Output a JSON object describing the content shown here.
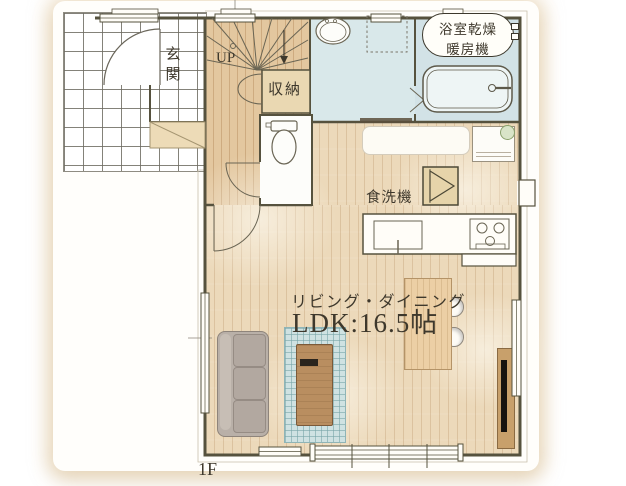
{
  "floorplan": {
    "floor_label": "1F",
    "rooms": {
      "entrance_label": "玄関",
      "stairs_label": "UP",
      "storage_label": "収納",
      "bath_heater_line1": "浴室乾燥",
      "bath_heater_line2": "暖房機",
      "dishwasher_label": "食洗機",
      "living_dining_label": "リビング・ダイニング",
      "ldk_size_label": "LDK:16.5帖"
    },
    "colors": {
      "wall": "#56523e",
      "wood_floor": "#ecd9ba",
      "hall_floor": "#e3c79f",
      "wet_area_floor": "#d9e8ea",
      "storage_fill": "#ead8b2",
      "rug": "#cfe2e2",
      "sofa": "#b9b0a8",
      "dining_table": "#eccfa5",
      "coffee_table": "#b98e60",
      "text": "#3e382c"
    },
    "icons": [
      "front-door-arc",
      "stairs-up-arrow",
      "storage-double-doors",
      "toilet",
      "washbasin",
      "washing-machine-pan",
      "bathtub",
      "folding-door",
      "sliding-window",
      "kitchen-sink",
      "gas-stove",
      "dishwasher",
      "refrigerator",
      "plant",
      "sofa",
      "rug",
      "coffee-table",
      "dining-table",
      "dining-chair",
      "tv",
      "tv-board",
      "back-door"
    ]
  }
}
